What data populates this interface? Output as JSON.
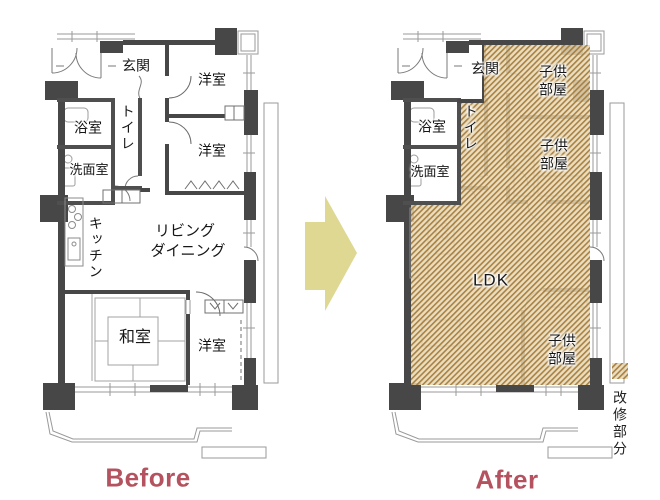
{
  "titles": {
    "before": "Before",
    "after": "After"
  },
  "legend": {
    "label": "改修部分"
  },
  "before_plan": {
    "rooms": {
      "genkan": "玄関",
      "western_room_1": "洋室",
      "bathroom": "浴室",
      "toilet": "トイレ",
      "western_room_2": "洋室",
      "washroom": "洗面室",
      "kitchen": "キッチン",
      "living_line1": "リビング",
      "living_line2": "ダイニング",
      "japanese_room": "和室",
      "western_room_3": "洋室"
    }
  },
  "after_plan": {
    "rooms": {
      "genkan": "玄関",
      "kids_room_1": "子供部屋",
      "bathroom": "浴室",
      "toilet": "トイレ",
      "kids_room_2": "子供部屋",
      "washroom": "洗面室",
      "ldk": "LDK",
      "kids_room_3": "子供部屋"
    }
  },
  "colors": {
    "accent_red": "#b4535f",
    "arrow_fill": "#ded893",
    "hatch_line": "#a37a39",
    "wall_dark": "#474747"
  }
}
